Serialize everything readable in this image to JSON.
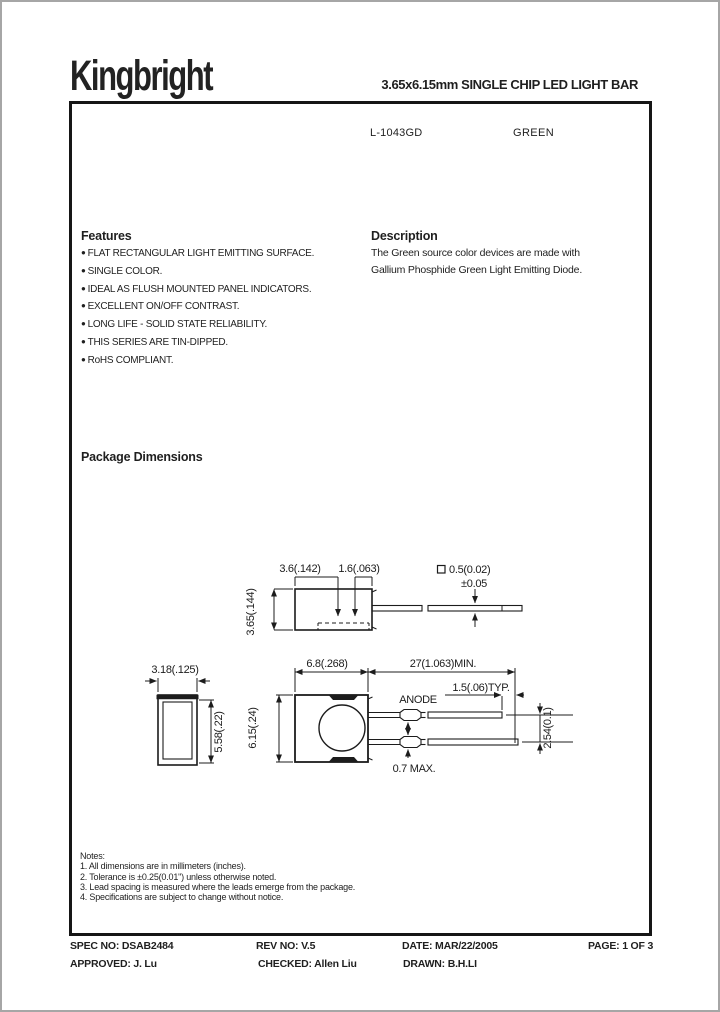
{
  "header": {
    "logo": "Kingbright",
    "title": "3.65x6.15mm SINGLE CHIP LED LIGHT BAR"
  },
  "part": {
    "number": "L-1043GD",
    "color": "GREEN"
  },
  "features": {
    "heading": "Features",
    "items": [
      "FLAT RECTANGULAR LIGHT EMITTING SURFACE.",
      "SINGLE COLOR.",
      "IDEAL AS FLUSH MOUNTED PANEL INDICATORS.",
      "EXCELLENT ON/OFF CONTRAST.",
      "LONG LIFE - SOLID STATE RELIABILITY.",
      "THIS SERIES ARE TIN-DIPPED.",
      "RoHS COMPLIANT."
    ]
  },
  "description": {
    "heading": "Description",
    "line1": "The Green source color devices are made with",
    "line2": "Gallium Phosphide Green Light Emitting Diode."
  },
  "package_dimensions": {
    "heading": "Package Dimensions",
    "side_view": {
      "width": "3.6(.142)",
      "segment": "1.6(.063)",
      "height": "3.65(.144)",
      "lead_square": "0.5(0.02)",
      "lead_tolerance": "±0.05"
    },
    "front_view": {
      "width": "3.18(.125)",
      "height": "5.58(.22)"
    },
    "lead_view": {
      "body_width": "6.8(.268)",
      "lead_length_min": "27(1.063)MIN.",
      "lead_tip": "1.5(.06)TYP.",
      "anode": "ANODE",
      "body_height": "6.15(.24)",
      "lead_thickness_max": "0.7 MAX.",
      "lead_pitch": "2.54(0.1)"
    }
  },
  "notes": {
    "heading": "Notes:",
    "items": [
      "1. All dimensions are in millimeters (inches).",
      "2. Tolerance is ±0.25(0.01\") unless otherwise noted.",
      "3. Lead spacing is measured where the leads emerge from the package.",
      "4. Specifications are subject to change without notice."
    ]
  },
  "footer": {
    "spec": {
      "label": "SPEC NO:",
      "value": "DSAB2484"
    },
    "rev": {
      "label": "REV NO:",
      "value": "V.5"
    },
    "date": {
      "label": "DATE:",
      "value": "MAR/22/2005"
    },
    "page": {
      "label": "PAGE:",
      "value": "1 OF 3"
    },
    "approved": {
      "label": "APPROVED:",
      "value": "J. Lu"
    },
    "checked": {
      "label": "CHECKED:",
      "value": "Allen Liu"
    },
    "drawn": {
      "label": "DRAWN:",
      "value": "B.H.LI"
    }
  }
}
